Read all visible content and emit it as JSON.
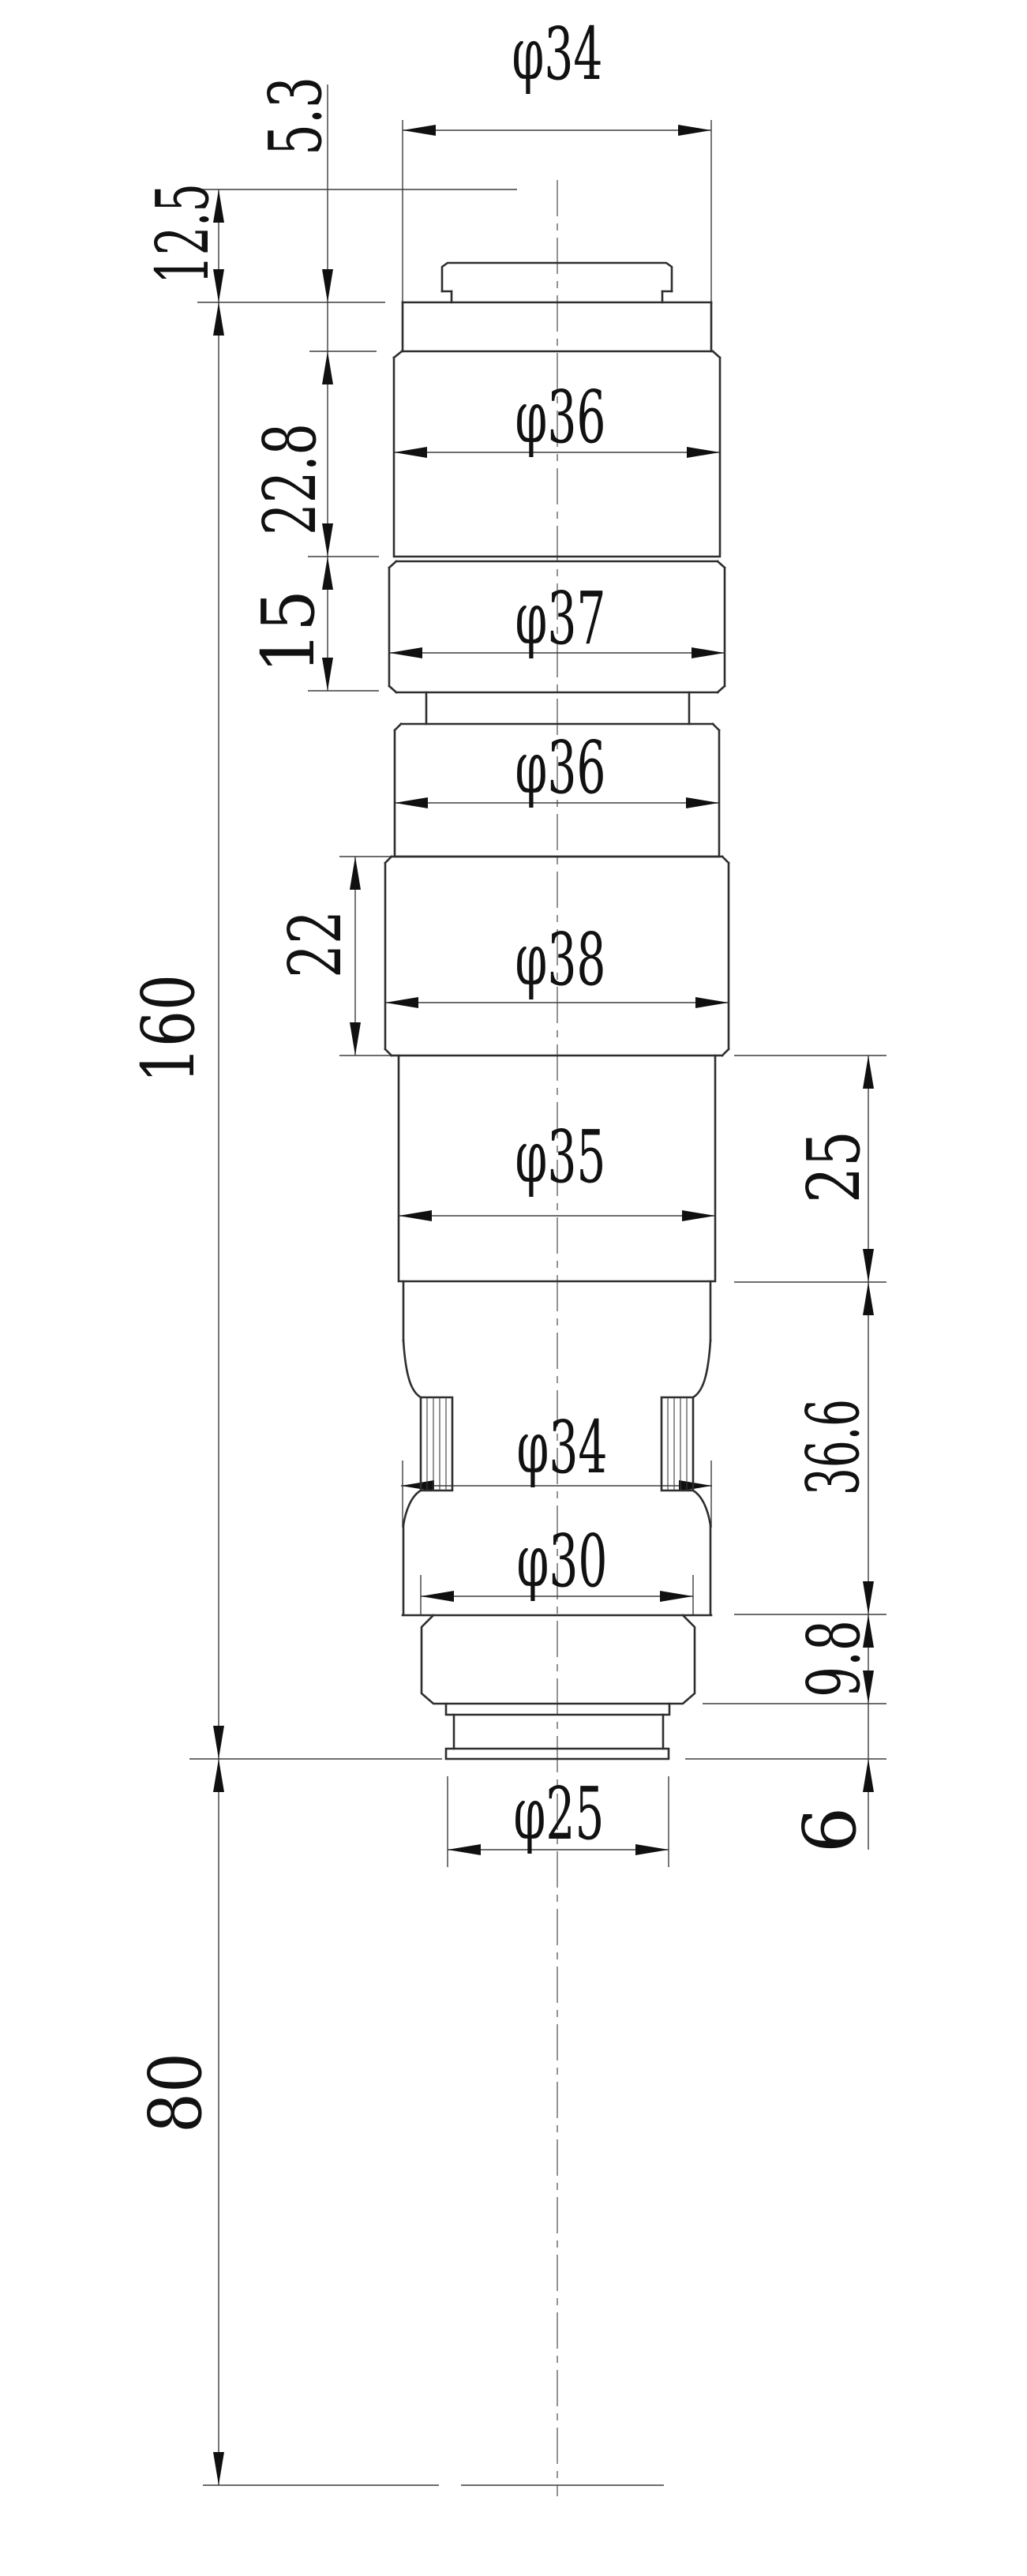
{
  "drawing": {
    "type": "mechanical engineering dimension drawing, cylindrical stepped part (lens barrel), front view",
    "units_note": "all values are dimension callouts visible in the drawing",
    "diameters_top_to_bottom": [
      34,
      36,
      37,
      36,
      38,
      35,
      34,
      30,
      25
    ],
    "lengths": {
      "left_chain": [
        5.3,
        12.5,
        22.8,
        15,
        22,
        160,
        80
      ],
      "right_chain": [
        25,
        36.6,
        9.8,
        6
      ]
    },
    "labels": {
      "dia_34_top": "φ34",
      "len_5_3": "5.3",
      "len_12_5": "12.5",
      "dia_36_upper": "φ36",
      "len_22_8": "22.8",
      "dia_37": "φ37",
      "len_15": "15",
      "dia_36_lower": "φ36",
      "len_160": "160",
      "dia_38": "φ38",
      "len_22": "22",
      "dia_35": "φ35",
      "len_25": "25",
      "dia_34_knurl": "φ34",
      "len_36_6": "36.6",
      "dia_30": "φ30",
      "len_9_8": "9.8",
      "dia_25": "φ25",
      "len_6": "6",
      "len_80": "80"
    },
    "colors": {
      "background": "#ffffff",
      "outline": "#2e2e2e",
      "thin_lines": "#3d3d3d",
      "text": "#111111"
    }
  }
}
